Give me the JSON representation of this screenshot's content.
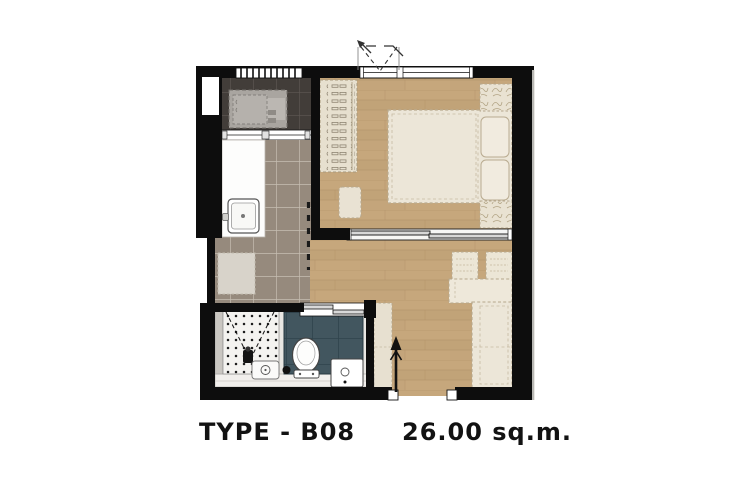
{
  "caption": {
    "type_label": "TYPE - B08",
    "area_label": "26.00 sq.m."
  },
  "colors": {
    "background": "#ffffff",
    "wall": "#0d0d0d",
    "wood_floor": "#c6a77c",
    "wood_plank_alt": "#b89a70",
    "wood_line": "#a98a61",
    "kitchen_tile": "#968a7d",
    "kitchen_grout": "#c6beb2",
    "balcony_tile": "#423d39",
    "balcony_grout": "#5f5954",
    "furniture_cream": "#ece6d8",
    "furniture_outline": "#b2a283",
    "wardrobe_fill": "#e7e0cf",
    "wet_tile_teal": "#42565f",
    "wet_tile_line": "#2f434c",
    "shower_floor": "#f4f3f0",
    "fixture_white": "#ffffff",
    "fixture_stroke": "#444444",
    "appliance_grey": "#a9a5a0",
    "rug_grey": "#d8d3ca",
    "bath_base": "#e9e7e3",
    "door_line": "#111111"
  },
  "icons": {
    "window_swing": "window-swing-icon",
    "entry_door_arrow": "door-swing-arrow-icon",
    "shower": "shower-icon",
    "toilet": "toilet-icon",
    "sink": "sink-icon",
    "drain": "floor-drain-icon"
  }
}
